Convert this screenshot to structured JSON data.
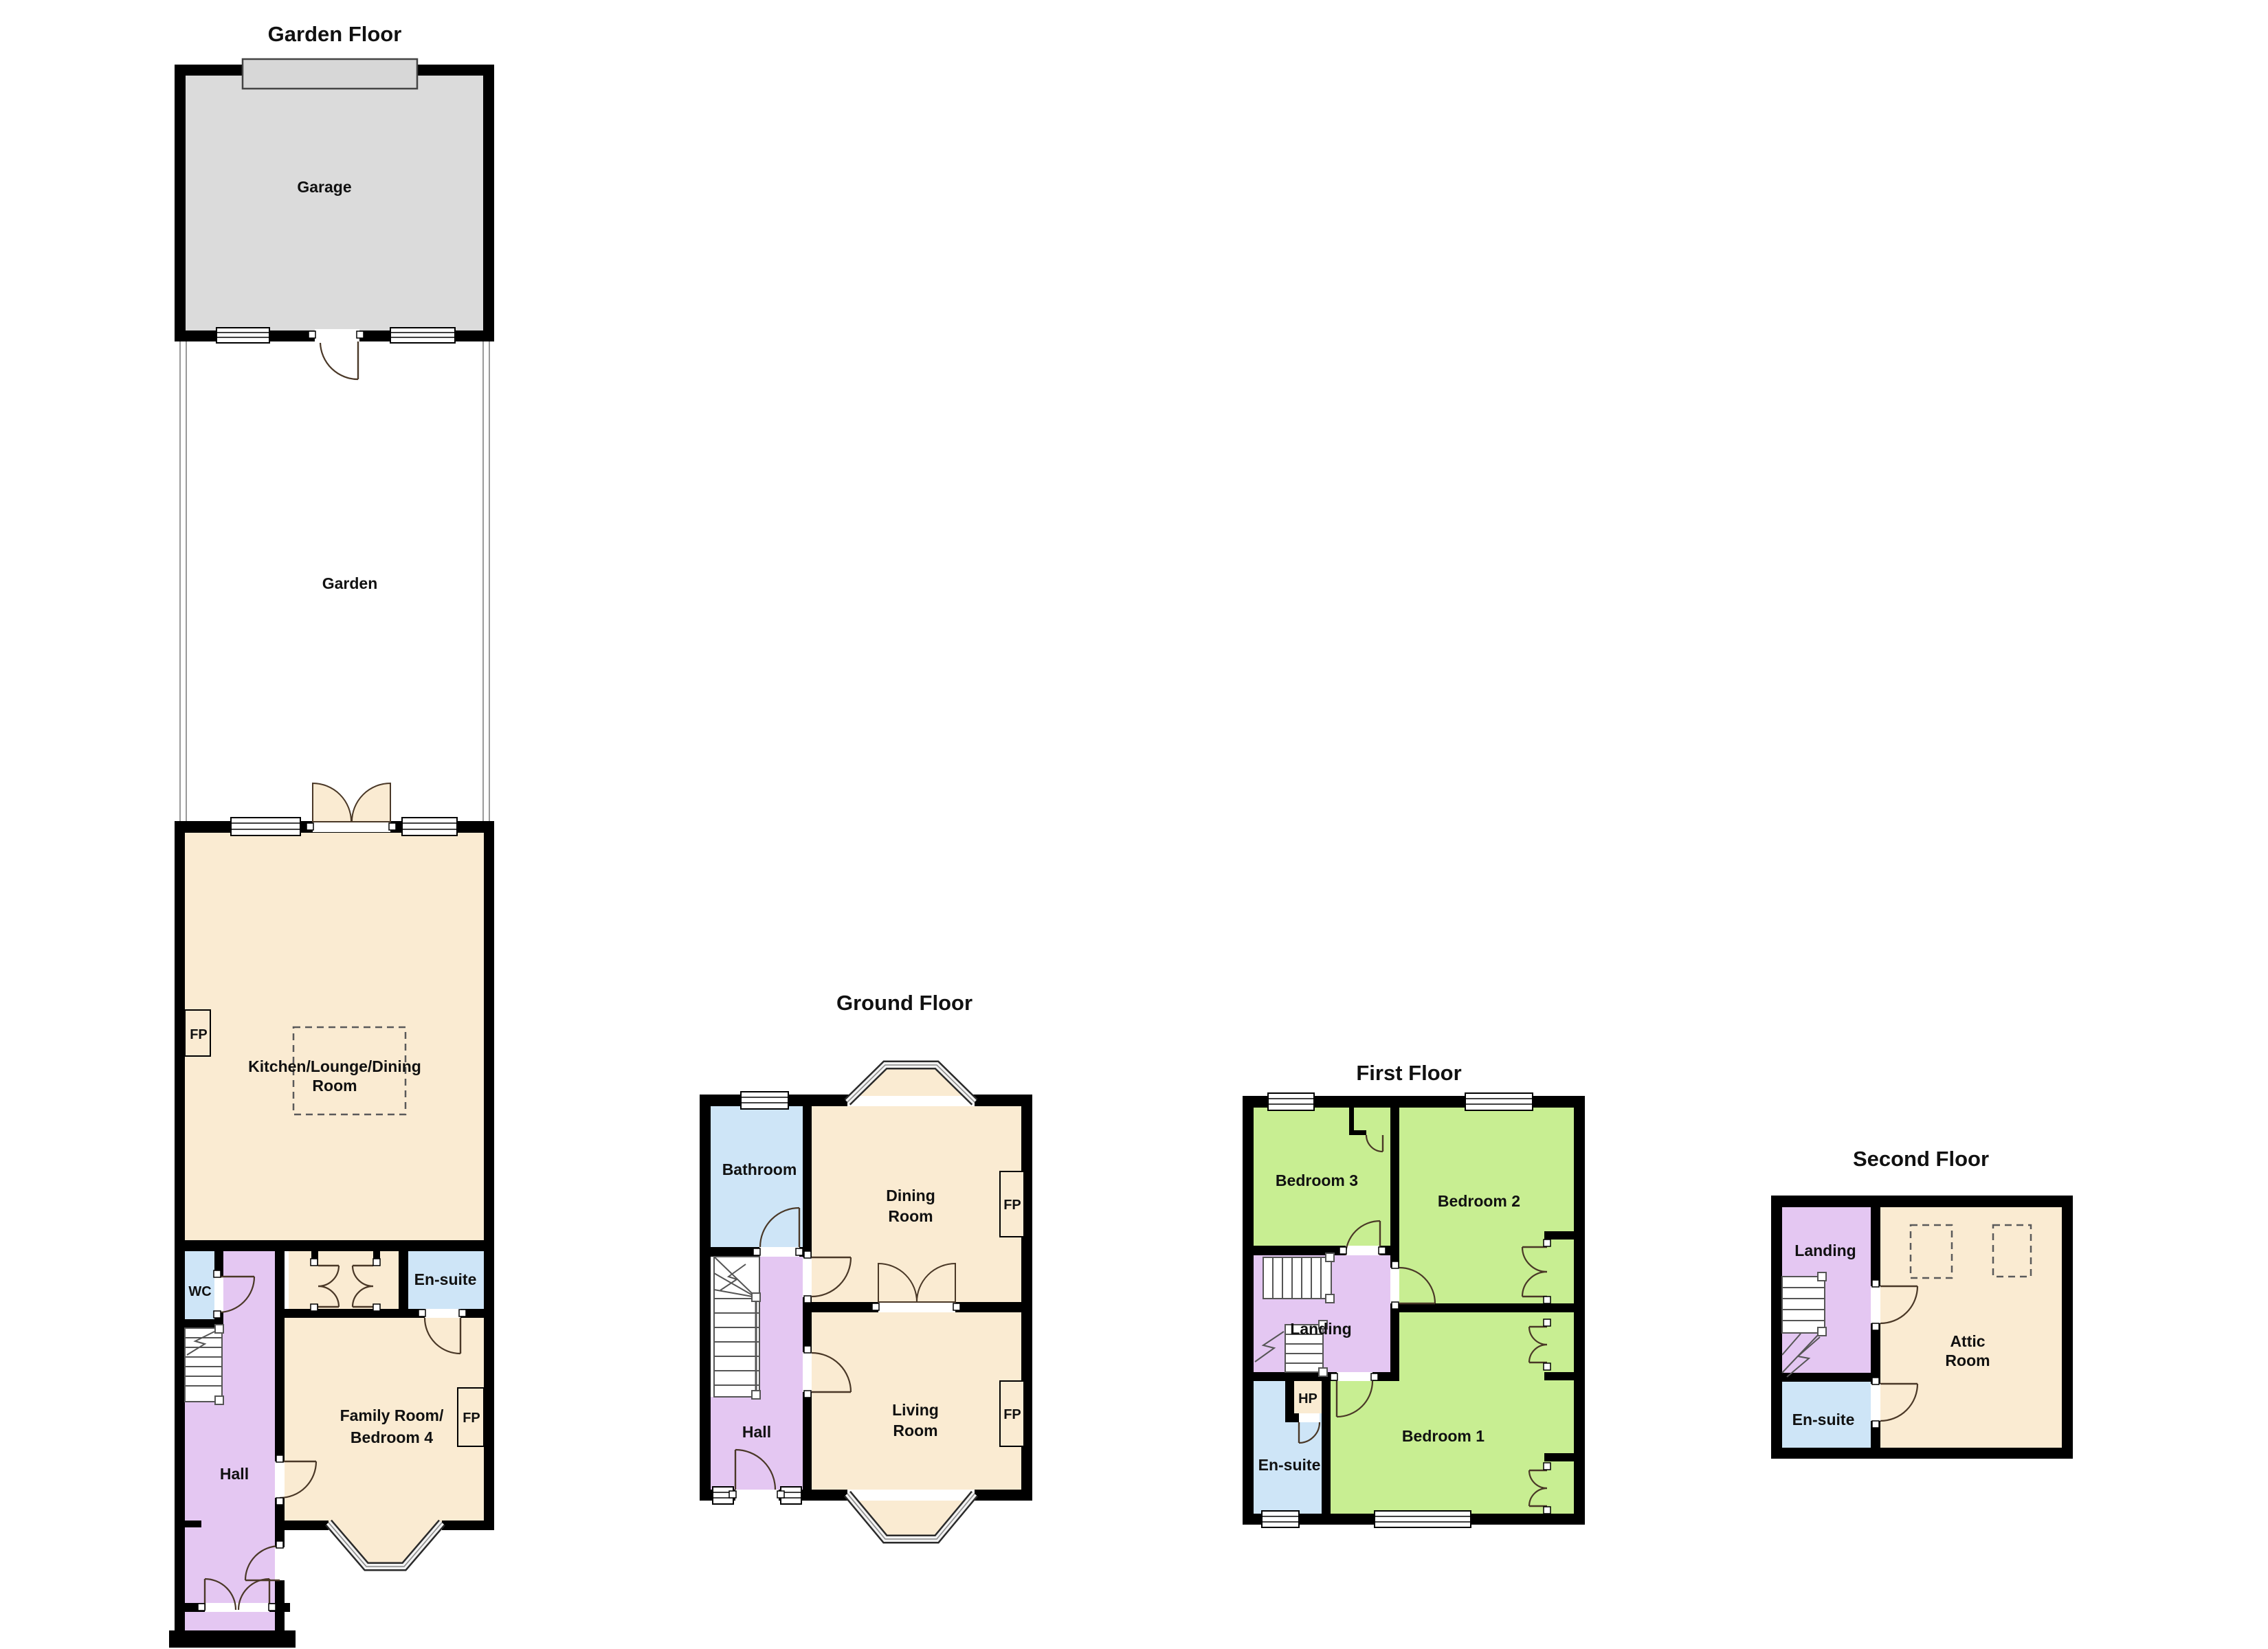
{
  "document_type": "property-floorplan",
  "colors": {
    "wall": "#000000",
    "beige": "#FAEBD2",
    "gray": "#DBDBDB",
    "gray_door": "#D7D7D7",
    "purple": "#E4C7F2",
    "blue": "#CEE5F7",
    "green": "#C8EE92",
    "white": "#FFFFFF"
  },
  "garden_floor": {
    "title": "Garden Floor",
    "garage": "Garage",
    "garden": "Garden",
    "kitchen1": "Kitchen/Lounge/Dining",
    "kitchen2": "Room",
    "fp": "FP",
    "wc": "WC",
    "ensuite": "En-suite",
    "family1": "Family Room/",
    "family2": "Bedroom 4",
    "hall": "Hall"
  },
  "ground_floor": {
    "title": "Ground Floor",
    "bathroom": "Bathroom",
    "dining1": "Dining",
    "dining2": "Room",
    "living1": "Living",
    "living2": "Room",
    "hall": "Hall",
    "fp": "FP"
  },
  "first_floor": {
    "title": "First Floor",
    "bedroom3": "Bedroom 3",
    "bedroom2": "Bedroom 2",
    "bedroom1": "Bedroom 1",
    "landing": "Landing",
    "hp": "HP",
    "ensuite": "En-suite"
  },
  "second_floor": {
    "title": "Second Floor",
    "landing": "Landing",
    "ensuite": "En-suite",
    "attic1": "Attic",
    "attic2": "Room"
  }
}
